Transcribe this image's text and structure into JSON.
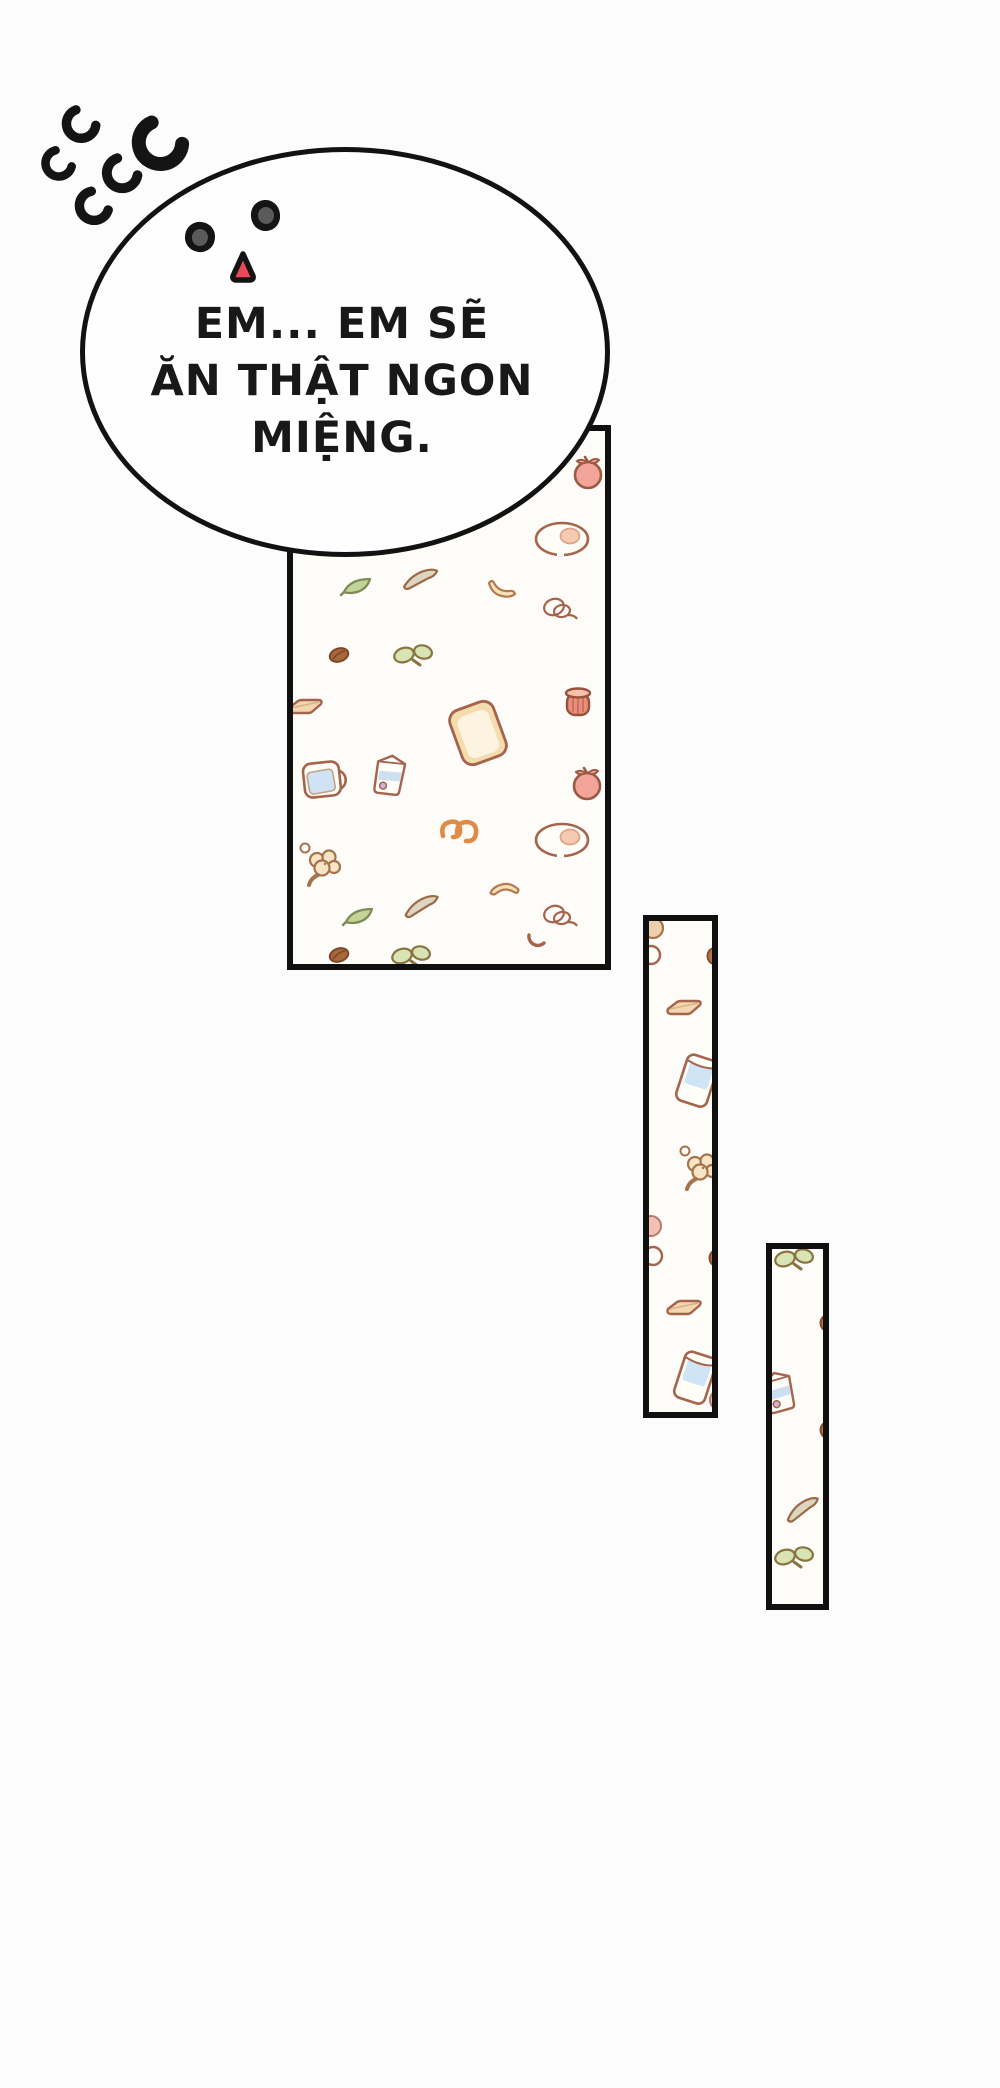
{
  "bubble": {
    "lines": [
      "EM... EM SẼ",
      "ĂN THẬT NGON",
      "MIỆNG."
    ]
  },
  "face": {
    "eye_color": "#141414",
    "pupil_color": "#5a5a5a",
    "mouth_color": "#ea4a58"
  },
  "colors": {
    "ink": "#121212",
    "panel_background": "#fdfcf8",
    "outline_brown": "#a5644c",
    "milk_blue": "#cfe4f5",
    "sprout_green": "#d8e4b4",
    "pretzel_orange": "#e08b45",
    "tomato_pink": "#f2a39a"
  },
  "decorations": {
    "motion_lines_count": 5
  },
  "panels": [
    {
      "name": "food-pattern-panel-large",
      "items": [
        {
          "icon": "tomato",
          "x": 298,
          "y": 44,
          "r": 0,
          "s": 1
        },
        {
          "icon": "egg",
          "x": 272,
          "y": 111,
          "r": 0,
          "s": 1
        },
        {
          "icon": "knife",
          "x": 133,
          "y": 150,
          "r": -8,
          "s": 1
        },
        {
          "icon": "leaf-green",
          "x": 72,
          "y": 158,
          "r": 0,
          "s": 1
        },
        {
          "icon": "banana",
          "x": 214,
          "y": 162,
          "r": 0,
          "s": 1
        },
        {
          "icon": "yarn",
          "x": 269,
          "y": 181,
          "r": 0,
          "s": 1
        },
        {
          "icon": "bean",
          "x": 49,
          "y": 227,
          "r": 0,
          "s": 1
        },
        {
          "icon": "sprout",
          "x": 125,
          "y": 231,
          "r": 0,
          "s": 1
        },
        {
          "icon": "bacon",
          "x": 16,
          "y": 277,
          "r": 0,
          "s": 1
        },
        {
          "icon": "jam-jar",
          "x": 288,
          "y": 274,
          "r": 0,
          "s": 1
        },
        {
          "icon": "bread",
          "x": 188,
          "y": 305,
          "r": -20,
          "s": 1.1
        },
        {
          "icon": "mug",
          "x": 37,
          "y": 352,
          "r": -6,
          "s": 1
        },
        {
          "icon": "milk-carton",
          "x": 102,
          "y": 347,
          "r": 10,
          "s": 1
        },
        {
          "icon": "tomato",
          "x": 297,
          "y": 355,
          "r": 0,
          "s": 1
        },
        {
          "icon": "pretzel",
          "x": 172,
          "y": 402,
          "r": 0,
          "s": 1
        },
        {
          "icon": "egg",
          "x": 272,
          "y": 412,
          "r": 0,
          "s": 1
        },
        {
          "icon": "dot-small",
          "x": 15,
          "y": 420,
          "r": 0,
          "s": 1
        },
        {
          "icon": "popcorn",
          "x": 35,
          "y": 438,
          "r": 0,
          "s": 1
        },
        {
          "icon": "banana",
          "x": 212,
          "y": 463,
          "r": 150,
          "s": 1
        },
        {
          "icon": "knife",
          "x": 134,
          "y": 477,
          "r": -12,
          "s": 1
        },
        {
          "icon": "leaf-green",
          "x": 74,
          "y": 488,
          "r": 0,
          "s": 1
        },
        {
          "icon": "yarn",
          "x": 269,
          "y": 488,
          "r": 0,
          "s": 1
        },
        {
          "icon": "small-curve",
          "x": 247,
          "y": 512,
          "r": 0,
          "s": 1
        },
        {
          "icon": "bean",
          "x": 49,
          "y": 527,
          "r": 0,
          "s": 1
        },
        {
          "icon": "sprout",
          "x": 123,
          "y": 532,
          "r": 0,
          "s": 1
        }
      ]
    },
    {
      "name": "food-pattern-panel-tall-left",
      "items": [
        {
          "icon": "circle-beige",
          "x": 7,
          "y": 10,
          "r": 0,
          "s": 1
        },
        {
          "icon": "circle-white",
          "x": 5,
          "y": 37,
          "r": 0,
          "s": 1
        },
        {
          "icon": "circle-brown",
          "x": 70,
          "y": 38,
          "r": 0,
          "s": 1
        },
        {
          "icon": "bacon",
          "x": 39,
          "y": 88,
          "r": 0,
          "s": 1
        },
        {
          "icon": "milk-glass",
          "x": 52,
          "y": 163,
          "r": 18,
          "s": 1
        },
        {
          "icon": "dot-small",
          "x": 39,
          "y": 233,
          "r": 0,
          "s": 1
        },
        {
          "icon": "popcorn",
          "x": 57,
          "y": 252,
          "r": 0,
          "s": 1
        },
        {
          "icon": "circle-pink",
          "x": 5,
          "y": 308,
          "r": 0,
          "s": 1
        },
        {
          "icon": "circle-white",
          "x": 7,
          "y": 338,
          "r": 0,
          "s": 1
        },
        {
          "icon": "circle-brown",
          "x": 72,
          "y": 340,
          "r": 0,
          "s": 1
        },
        {
          "icon": "bacon",
          "x": 39,
          "y": 388,
          "r": 0,
          "s": 1
        },
        {
          "icon": "milk-glass",
          "x": 50,
          "y": 460,
          "r": 18,
          "s": 1
        },
        {
          "icon": "circle-pink",
          "x": 74,
          "y": 482,
          "r": 0,
          "s": 1
        }
      ]
    },
    {
      "name": "food-pattern-panel-tall-right",
      "items": [
        {
          "icon": "sprout",
          "x": 27,
          "y": 17,
          "r": 0,
          "s": 1
        },
        {
          "icon": "circle-brown",
          "x": 60,
          "y": 77,
          "r": 0,
          "s": 1
        },
        {
          "icon": "milk-carton",
          "x": 12,
          "y": 145,
          "r": -12,
          "s": 1
        },
        {
          "icon": "circle-brown",
          "x": 60,
          "y": 184,
          "r": 0,
          "s": 1
        },
        {
          "icon": "knife",
          "x": 36,
          "y": 262,
          "r": -18,
          "s": 1
        },
        {
          "icon": "sprout",
          "x": 27,
          "y": 315,
          "r": 0,
          "s": 1
        }
      ]
    }
  ]
}
